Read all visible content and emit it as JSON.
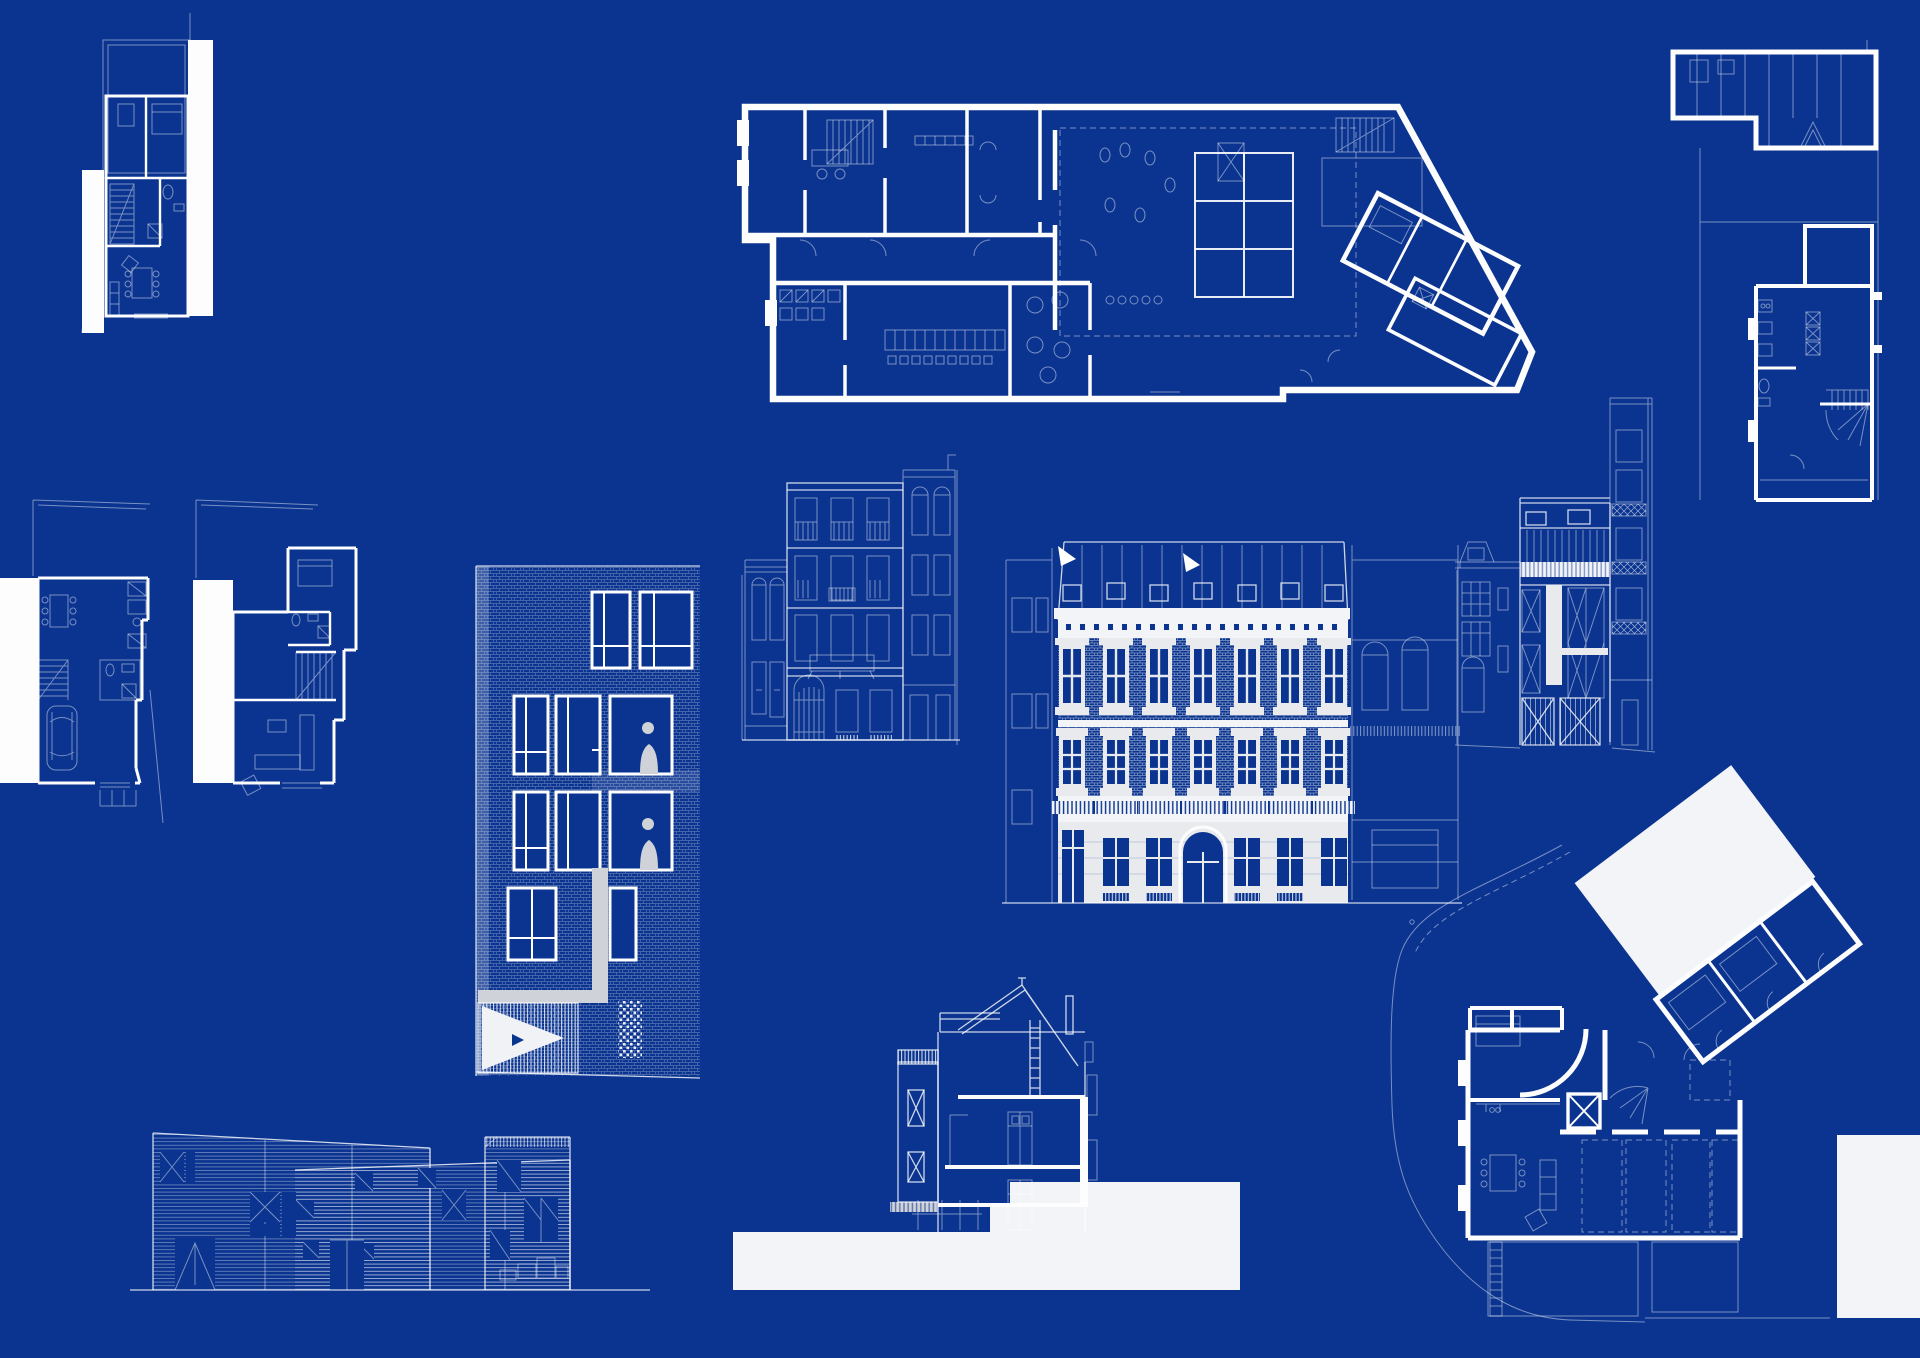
{
  "board": {
    "label": "architectural blueprint presentation board",
    "width": 1920,
    "height": 1358
  },
  "palette": {
    "bg": "#0a3490",
    "white": "#fdfdfe",
    "offwhite": "#f2f4f8",
    "facade": "#e8eaee",
    "grey": "#cfd2d8"
  },
  "drawings": [
    {
      "name": "drawing-plan-small-house",
      "label": "floor plan of narrow row house with white party wall",
      "kind": "floor-plan",
      "x": 82,
      "y": 13,
      "w": 132,
      "h": 320
    },
    {
      "name": "drawing-plan-ground-floor-large",
      "label": "large trapezoidal ground floor plan with courtyard grid",
      "kind": "floor-plan",
      "x": 735,
      "y": 95,
      "w": 800,
      "h": 310
    },
    {
      "name": "drawing-plan-roof-terrace",
      "label": "upper floor plan with hatched roof deck",
      "kind": "floor-plan",
      "x": 1660,
      "y": 40,
      "w": 230,
      "h": 465
    },
    {
      "name": "drawing-plan-house-garage",
      "label": "house plan with garage and car",
      "kind": "floor-plan",
      "x": 0,
      "y": 496,
      "w": 165,
      "h": 330
    },
    {
      "name": "drawing-plan-house-living",
      "label": "house plan with living room and stair",
      "kind": "floor-plan",
      "x": 190,
      "y": 496,
      "w": 170,
      "h": 300
    },
    {
      "name": "drawing-elevation-brick-tower",
      "label": "brick apartment tower elevation with figures",
      "kind": "elevation",
      "x": 476,
      "y": 566,
      "w": 224,
      "h": 512
    },
    {
      "name": "drawing-elevation-street-townhouse",
      "label": "street elevation of four storey townhouse with balconies",
      "kind": "elevation",
      "x": 742,
      "y": 455,
      "w": 215,
      "h": 290
    },
    {
      "name": "drawing-elevation-classical-mansion",
      "label": "classical mansion elevation with mansard roof",
      "kind": "elevation",
      "x": 1002,
      "y": 525,
      "w": 460,
      "h": 382
    },
    {
      "name": "drawing-elevation-modern-infill",
      "label": "modern infill elevation with garage doors",
      "kind": "elevation",
      "x": 1455,
      "y": 398,
      "w": 200,
      "h": 352
    },
    {
      "name": "drawing-elevation-timber-building",
      "label": "long timber clad building elevation",
      "kind": "elevation",
      "x": 130,
      "y": 1130,
      "w": 540,
      "h": 162
    },
    {
      "name": "drawing-section-town-house",
      "label": "cross section of gabled town house on white ground mass",
      "kind": "section",
      "x": 733,
      "y": 980,
      "w": 510,
      "h": 312
    },
    {
      "name": "drawing-plan-corner-villa",
      "label": "corner villa plan with rotated white roof slab and parking",
      "kind": "floor-plan",
      "x": 1390,
      "y": 780,
      "w": 420,
      "h": 545
    },
    {
      "name": "blank-white-panel",
      "label": "blank white panel at board edge",
      "kind": "panel",
      "x": 1837,
      "y": 1135,
      "w": 83,
      "h": 183
    }
  ]
}
